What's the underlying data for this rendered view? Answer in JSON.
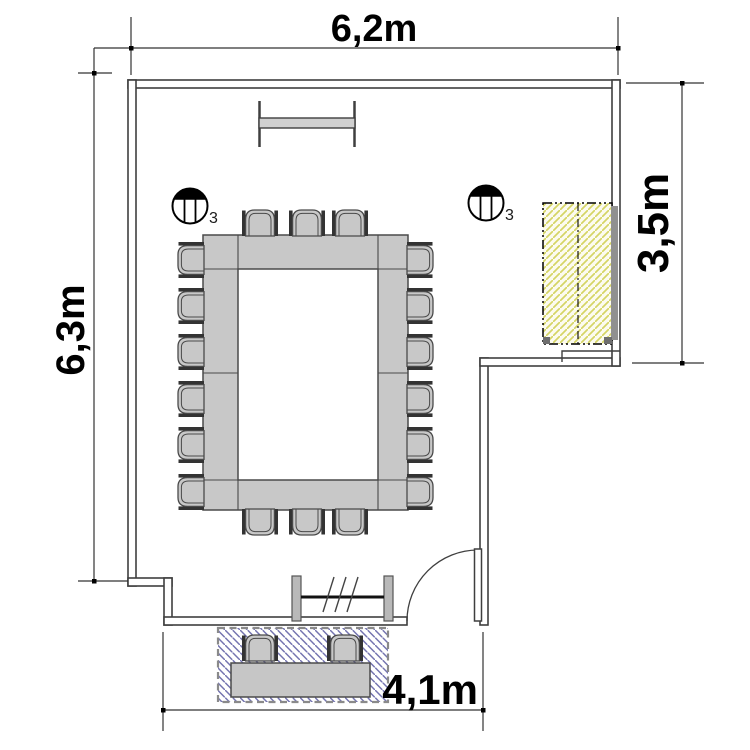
{
  "plan": {
    "dimensions": {
      "width_top": "6,2m",
      "height_left": "6,3m",
      "height_right": "3,5m",
      "width_bottom": "4,1m"
    },
    "light_fixtures": {
      "left_label": "3",
      "right_label": "3"
    },
    "content_summary": {
      "chairs_around_table": 18,
      "chairs_on_terrace": 2,
      "ceiling_lights": 2
    },
    "colors": {
      "wall_line": "#3f3f3f",
      "furniture_fill": "#c8c8c8",
      "furniture_stroke": "#4a4a4a",
      "armrest": "#333333",
      "sideboard_hatch_line": "#d5d565",
      "sideboard_hatch_bg": "#fcfbf0",
      "terrace_hatch_line": "#7474b0",
      "terrace_border": "#8a8a8a",
      "dimension_line": "#333333",
      "dimension_text": "#000000"
    }
  }
}
